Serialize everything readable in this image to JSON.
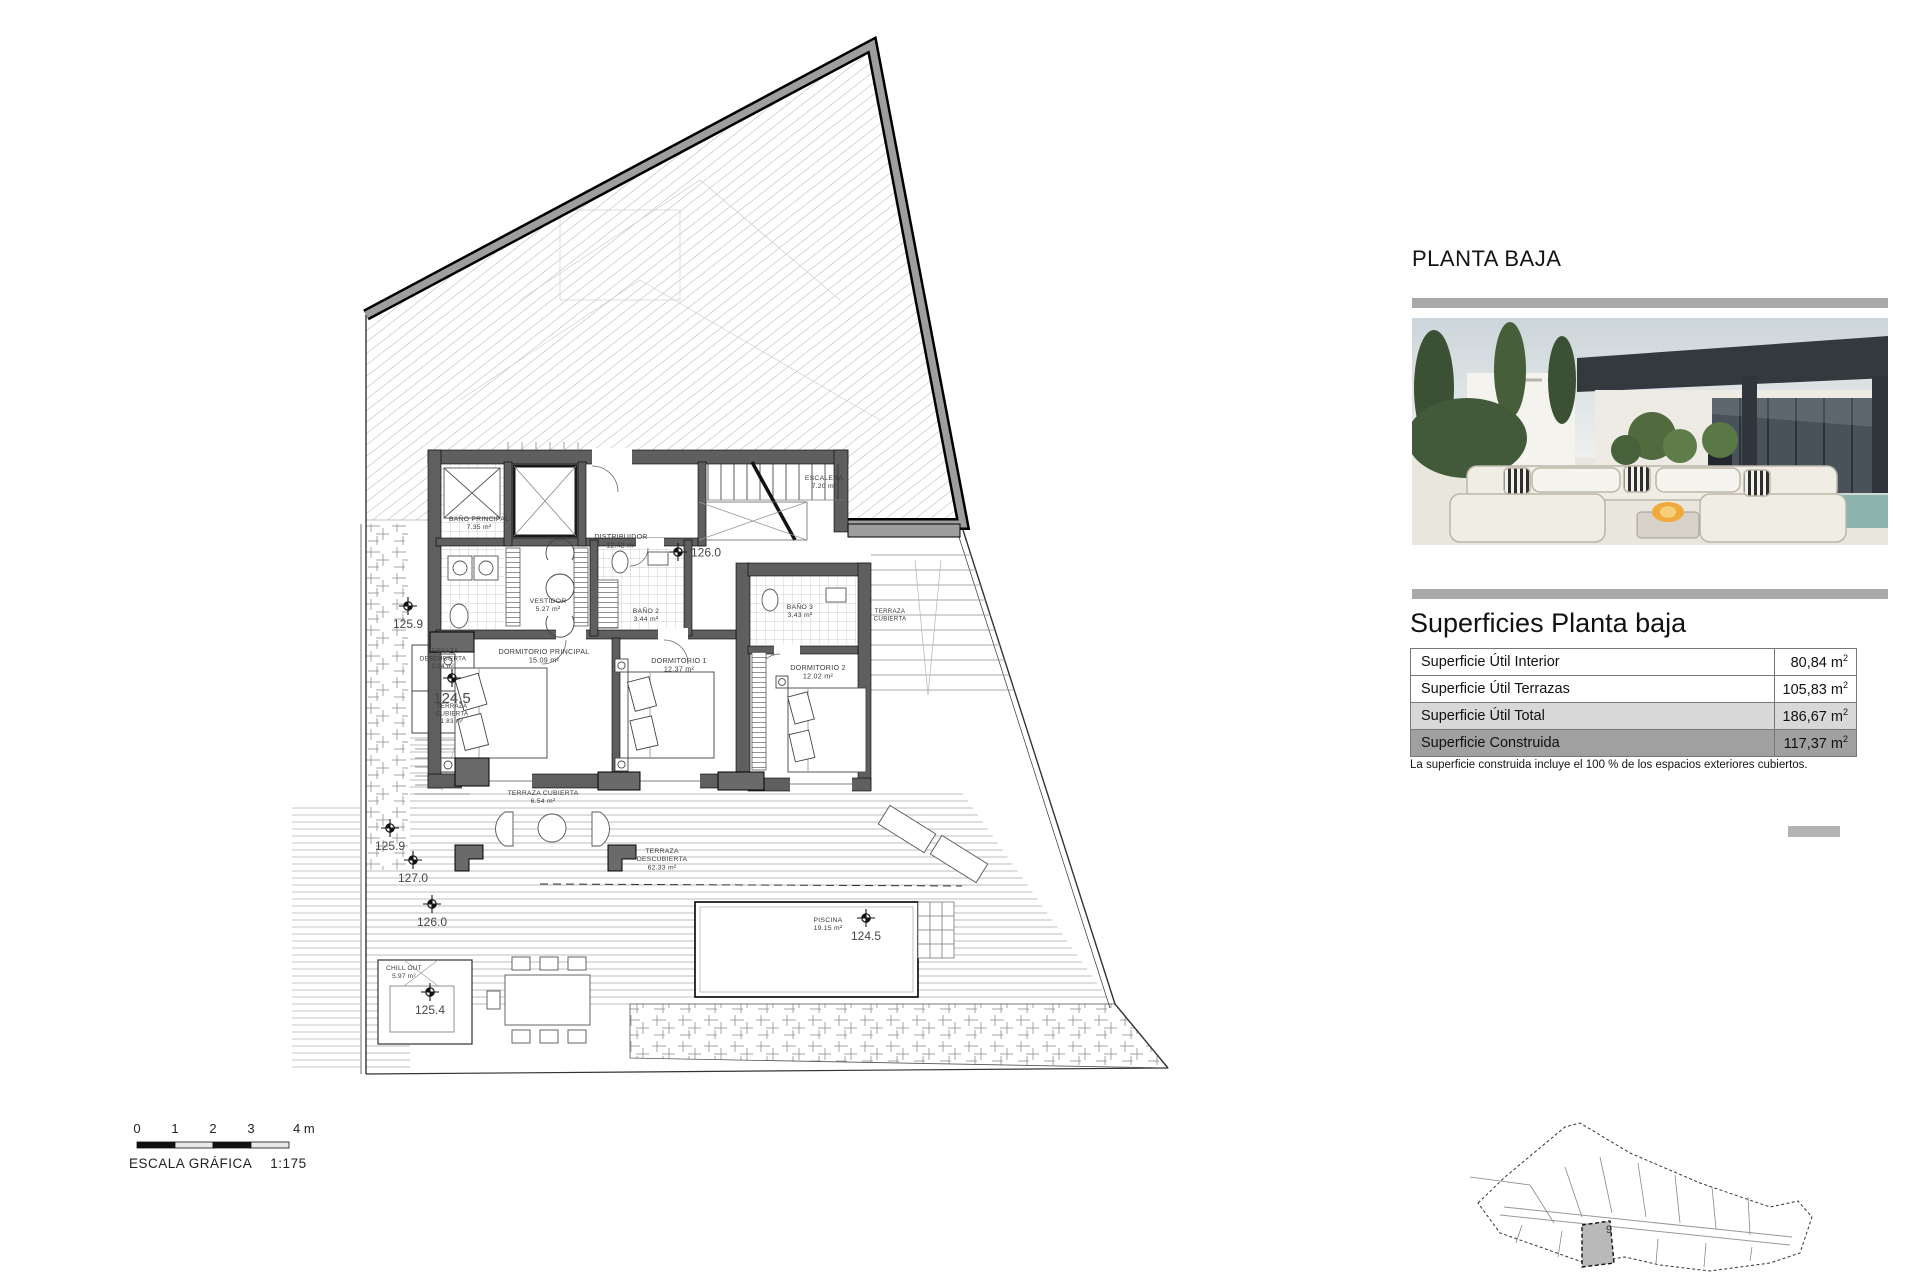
{
  "page": {
    "title": "PLANTA BAJA"
  },
  "surfaces": {
    "heading": "Superficies Planta baja",
    "rows": [
      {
        "label": "Superficie Útil Interior",
        "value": "80,84",
        "unit": "m",
        "sup": "2"
      },
      {
        "label": "Superficie Útil Terrazas",
        "value": "105,83",
        "unit": "m",
        "sup": "2"
      },
      {
        "label": "Superficie Útil Total",
        "value": "186,67",
        "unit": "m",
        "sup": "2"
      },
      {
        "label": "Superficie Construida",
        "value": "117,37",
        "unit": "m",
        "sup": "2"
      }
    ],
    "footnote": "La superficie construida incluye el 100 % de los espacios exteriores cubiertos."
  },
  "scale_bar": {
    "ticks": [
      "0",
      "1",
      "2",
      "3"
    ],
    "end_label": "4 m",
    "caption": "ESCALA GRÁFICA",
    "ratio": "1:175"
  },
  "site_plan": {
    "highlighted_plot": "9"
  },
  "floor_plan": {
    "room_labels": [
      {
        "lines": [
          "BAÑO PRINCIPAL",
          "7.35 m²"
        ],
        "x": 479,
        "y": 521,
        "size": 6.8
      },
      {
        "lines": [
          "DISTRIBUIDOR",
          "12.42 m²"
        ],
        "x": 621,
        "y": 539,
        "size": 7
      },
      {
        "lines": [
          "ESCALERA",
          "7.20 m²"
        ],
        "x": 824,
        "y": 480,
        "size": 6.8
      },
      {
        "lines": [
          "VESTIDOR",
          "5.27 m²"
        ],
        "x": 548,
        "y": 603,
        "size": 6.8
      },
      {
        "lines": [
          "BAÑO 2",
          "3.44 m²"
        ],
        "x": 646,
        "y": 613,
        "size": 6.8
      },
      {
        "lines": [
          "BAÑO 3",
          "3.43 m²"
        ],
        "x": 800,
        "y": 609,
        "size": 6.8
      },
      {
        "lines": [
          "DORMITORIO PRINCIPAL",
          "15.09 m²"
        ],
        "x": 544,
        "y": 654,
        "size": 7.2
      },
      {
        "lines": [
          "DORMITORIO 1",
          "12.37 m²"
        ],
        "x": 679,
        "y": 663,
        "size": 7.2
      },
      {
        "lines": [
          "DORMITORIO 2",
          "12.02 m²"
        ],
        "x": 818,
        "y": 670,
        "size": 7.2
      },
      {
        "lines": [
          "TERRAZA",
          "DESCUBIERTA",
          "1.24 m²"
        ],
        "x": 443,
        "y": 653,
        "size": 6.2
      },
      {
        "lines": [
          "TERRAZA",
          "CUBIERTA",
          "1.83 m²"
        ],
        "x": 452,
        "y": 708,
        "size": 6.2
      },
      {
        "lines": [
          "TERRAZA CUBIERTA",
          "6.54 m²"
        ],
        "x": 543,
        "y": 795,
        "size": 6.8
      },
      {
        "lines": [
          "TERRAZA",
          "DESCUBIERTA",
          "62.33 m²"
        ],
        "x": 662,
        "y": 853,
        "size": 6.8
      },
      {
        "lines": [
          "TERRAZA",
          "CUBIERTA"
        ],
        "x": 890,
        "y": 613,
        "size": 6.2
      },
      {
        "lines": [
          "CHILL OUT",
          "5.97 m²"
        ],
        "x": 404,
        "y": 970,
        "size": 6.5
      },
      {
        "lines": [
          "PISCINA",
          "19.15 m²"
        ],
        "x": 828,
        "y": 922,
        "size": 6.8
      }
    ],
    "level_markers": [
      {
        "value": "126.0",
        "x": 678,
        "y": 552,
        "anchor": "right",
        "size": 12
      },
      {
        "value": "125.9",
        "x": 408,
        "y": 606,
        "anchor": "below",
        "size": 12
      },
      {
        "value": "124.5",
        "x": 452,
        "y": 678,
        "anchor": "below",
        "size": 15
      },
      {
        "value": "125.9",
        "x": 390,
        "y": 828,
        "anchor": "below",
        "size": 12
      },
      {
        "value": "127.0",
        "x": 413,
        "y": 860,
        "anchor": "below",
        "size": 12
      },
      {
        "value": "126.0",
        "x": 432,
        "y": 904,
        "anchor": "below",
        "size": 12
      },
      {
        "value": "124.5",
        "x": 866,
        "y": 918,
        "anchor": "below",
        "size": 12
      },
      {
        "value": "125.4",
        "x": 430,
        "y": 992,
        "anchor": "below",
        "size": 12
      }
    ]
  }
}
